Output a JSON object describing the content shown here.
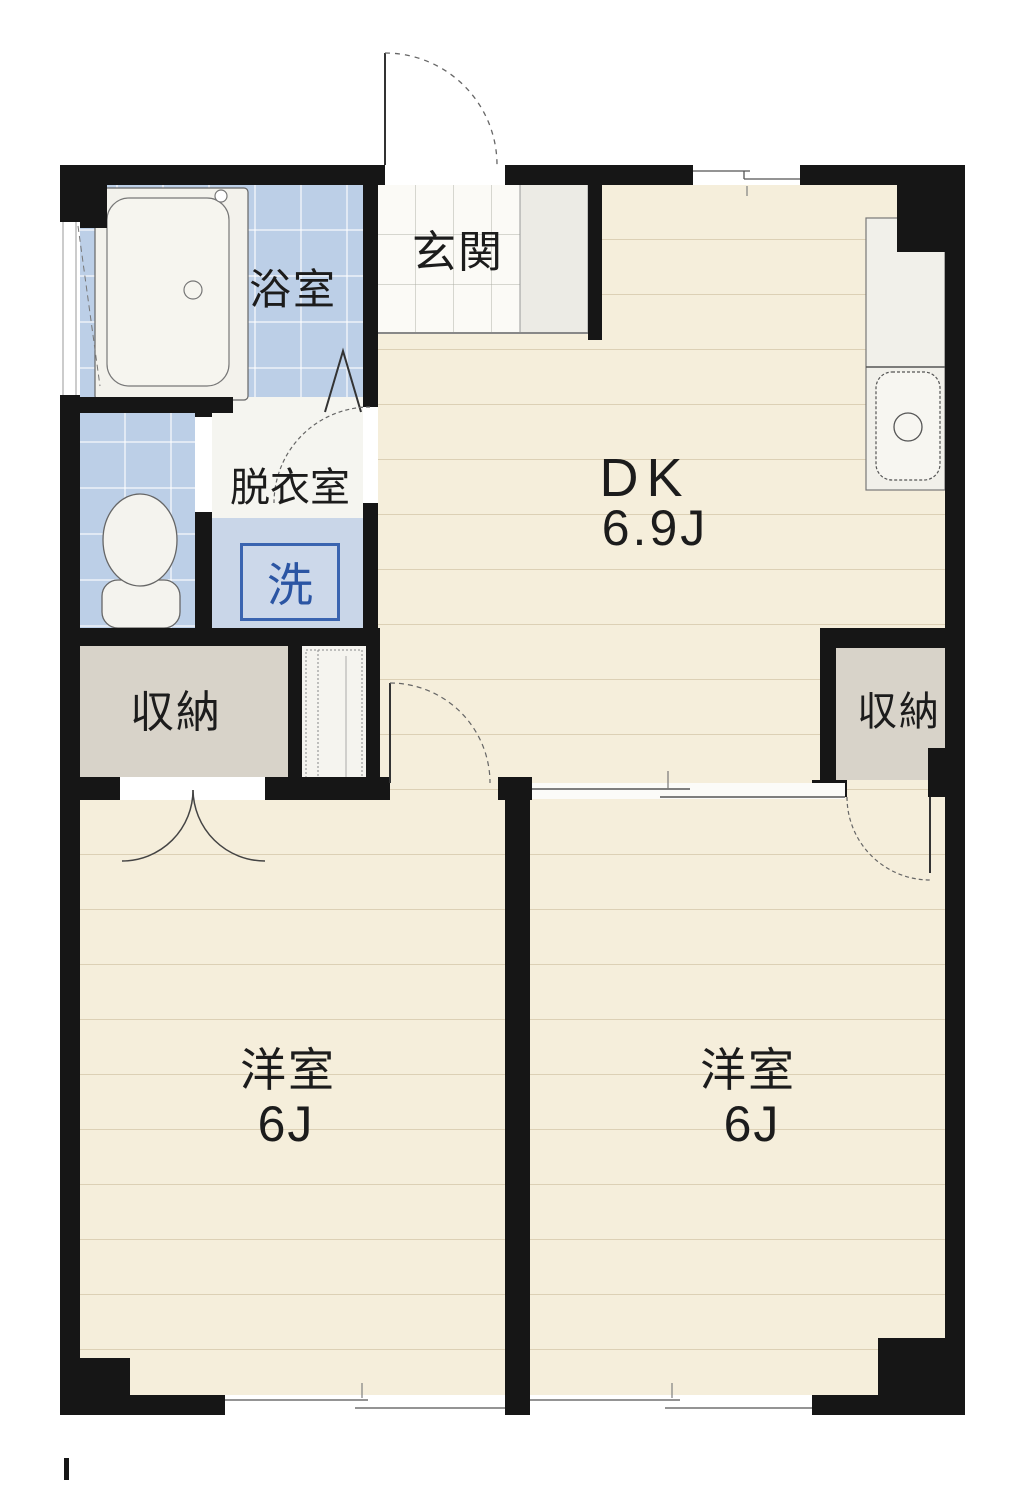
{
  "rooms": {
    "genkan": {
      "label": "玄関"
    },
    "bathroom": {
      "label": "浴室"
    },
    "dressing_room": {
      "label": "脱衣室"
    },
    "washing_machine": {
      "label": "洗"
    },
    "dining_kitchen": {
      "label": "DK",
      "size": "6.9J"
    },
    "closet_left": {
      "label": "収納"
    },
    "closet_right": {
      "label": "収納"
    },
    "bedroom_left": {
      "label": "洋室",
      "size": "6J"
    },
    "bedroom_right": {
      "label": "洋室",
      "size": "6J"
    }
  },
  "colors": {
    "wall": "#161616",
    "wet_area_blue": "#bccfe7",
    "floor_cream": "#f5eedb",
    "closet_grey": "#d8d3c9",
    "tile_white": "#fbfaf6",
    "washer_text_blue": "#2b55a3",
    "washer_border_blue": "#3a64b0",
    "line_grey": "#555555"
  },
  "fixtures": {
    "bathtub": "bathtub",
    "toilet": "toilet",
    "kitchen_sink": "kitchen-sink",
    "kitchen_counter": "kitchen-counter",
    "shoe_cabinet": "shoe-cabinet",
    "water_heater": "water-heater-space"
  }
}
